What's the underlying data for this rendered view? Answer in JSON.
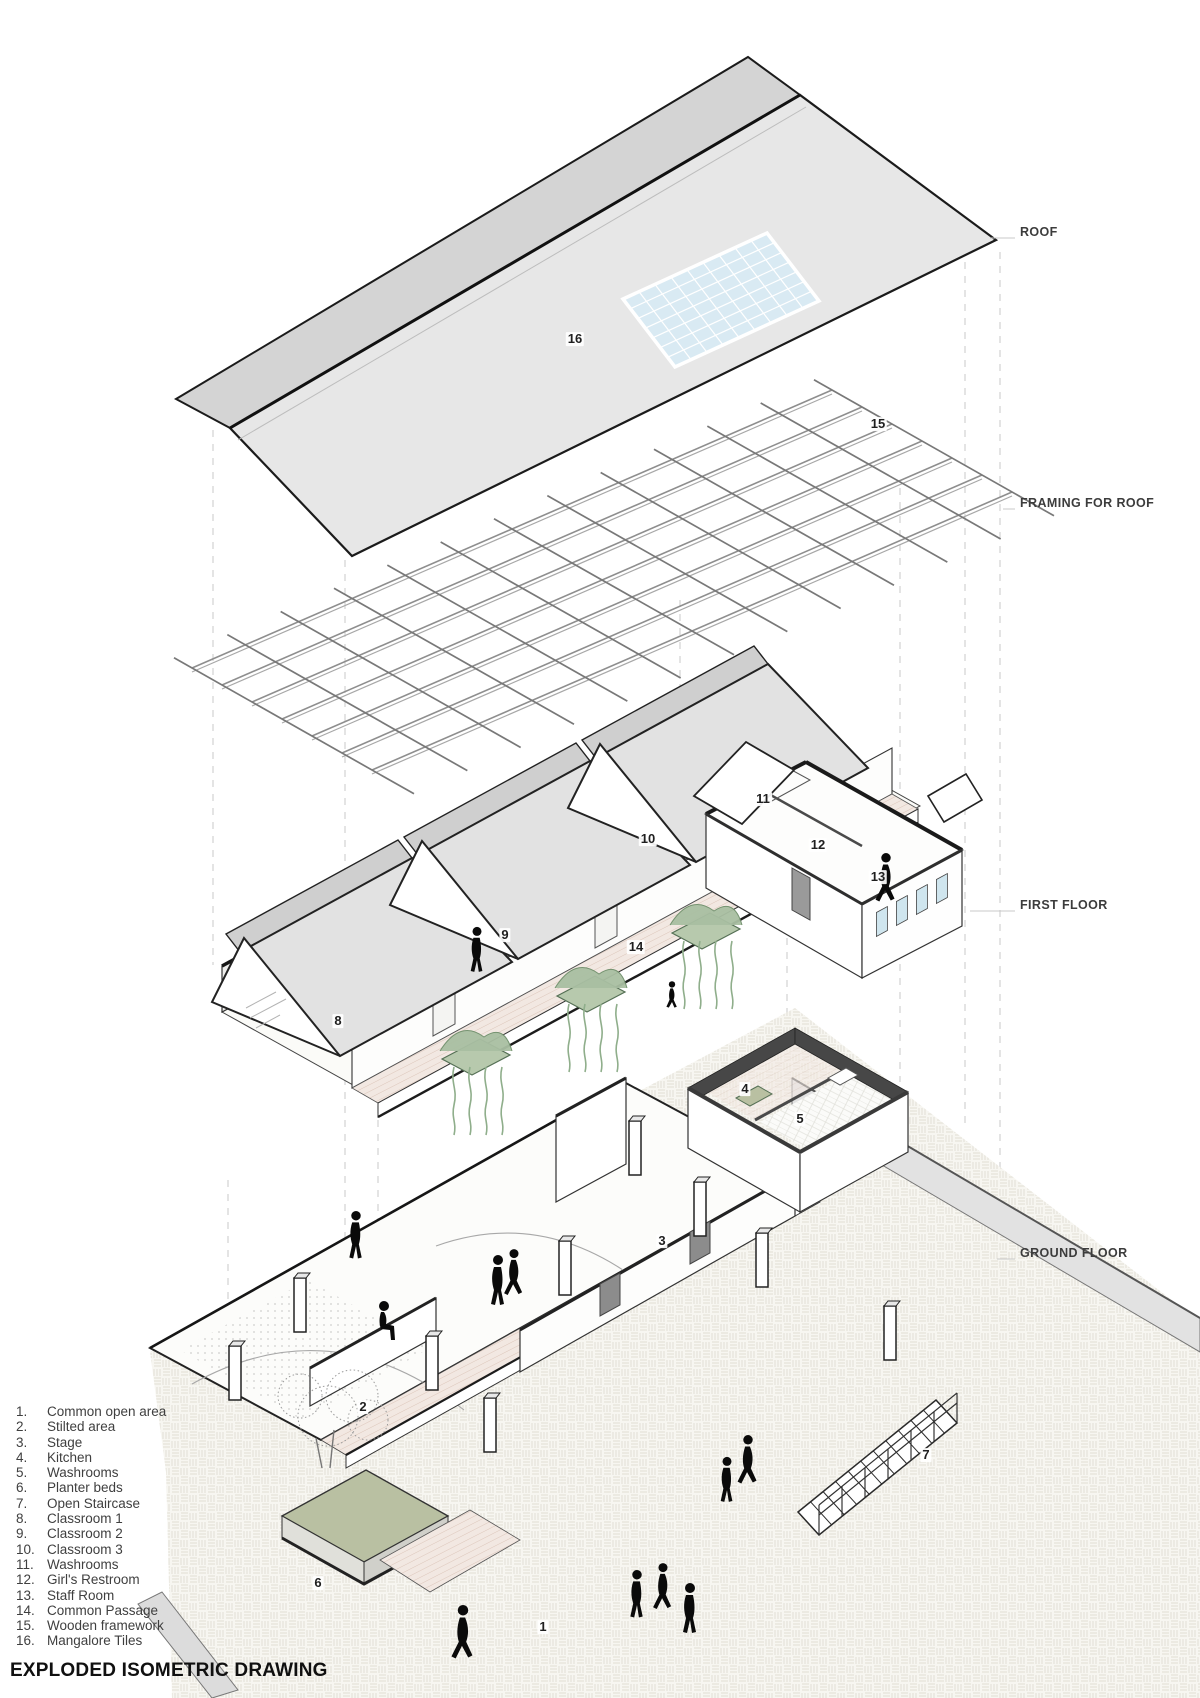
{
  "title": "EXPLODED ISOMETRIC DRAWING",
  "layer_labels": [
    {
      "text": "ROOF",
      "x": 1020,
      "y": 232
    },
    {
      "text": "FRAMING FOR ROOF",
      "x": 1020,
      "y": 503
    },
    {
      "text": "FIRST FLOOR",
      "x": 1020,
      "y": 905
    },
    {
      "text": "GROUND FLOOR",
      "x": 1020,
      "y": 1253
    }
  ],
  "legend": {
    "items": [
      {
        "n": "1.",
        "label": "Common open area"
      },
      {
        "n": "2.",
        "label": "Stilted area"
      },
      {
        "n": "3.",
        "label": "Stage"
      },
      {
        "n": "4.",
        "label": "Kitchen"
      },
      {
        "n": "5.",
        "label": "Washrooms"
      },
      {
        "n": "6.",
        "label": "Planter beds"
      },
      {
        "n": "7.",
        "label": "Open Staircase"
      },
      {
        "n": "8.",
        "label": "Classroom 1"
      },
      {
        "n": "9.",
        "label": "Classroom 2"
      },
      {
        "n": "10.",
        "label": "Classroom 3"
      },
      {
        "n": "11.",
        "label": "Washrooms"
      },
      {
        "n": "12.",
        "label": "Girl's Restroom"
      },
      {
        "n": "13.",
        "label": "Staff Room"
      },
      {
        "n": "14.",
        "label": "Common Passage"
      },
      {
        "n": "15.",
        "label": "Wooden framework"
      },
      {
        "n": "16.",
        "label": "Mangalore Tiles"
      }
    ]
  },
  "annotations": [
    {
      "n": "16",
      "x": 575,
      "y": 340
    },
    {
      "n": "15",
      "x": 878,
      "y": 425
    },
    {
      "n": "11",
      "x": 763,
      "y": 800
    },
    {
      "n": "12",
      "x": 818,
      "y": 846
    },
    {
      "n": "13",
      "x": 878,
      "y": 878
    },
    {
      "n": "10",
      "x": 648,
      "y": 840
    },
    {
      "n": "9",
      "x": 505,
      "y": 936
    },
    {
      "n": "8",
      "x": 338,
      "y": 1022
    },
    {
      "n": "14",
      "x": 636,
      "y": 948
    },
    {
      "n": "4",
      "x": 745,
      "y": 1090
    },
    {
      "n": "5",
      "x": 800,
      "y": 1120
    },
    {
      "n": "3",
      "x": 662,
      "y": 1242
    },
    {
      "n": "2",
      "x": 363,
      "y": 1408
    },
    {
      "n": "6",
      "x": 318,
      "y": 1584
    },
    {
      "n": "7",
      "x": 926,
      "y": 1456
    },
    {
      "n": "1",
      "x": 543,
      "y": 1628
    }
  ],
  "colors": {
    "roof_main": "#e7e7e7",
    "roof_far": "#d4d4d4",
    "skylight": "#d9eaf3",
    "outline": "#1b1b1b",
    "framing": "#8e8e8e",
    "wall_white": "#fdfdfc",
    "wall_shade": "#ededeb",
    "dark_cap": "#474747",
    "window_glass": "#cfe5ee",
    "plant_green": "#a9bfa2",
    "planter_olive": "#b9c0a2",
    "paving_line": "#e6e3da",
    "text": "#3f3f3f"
  }
}
